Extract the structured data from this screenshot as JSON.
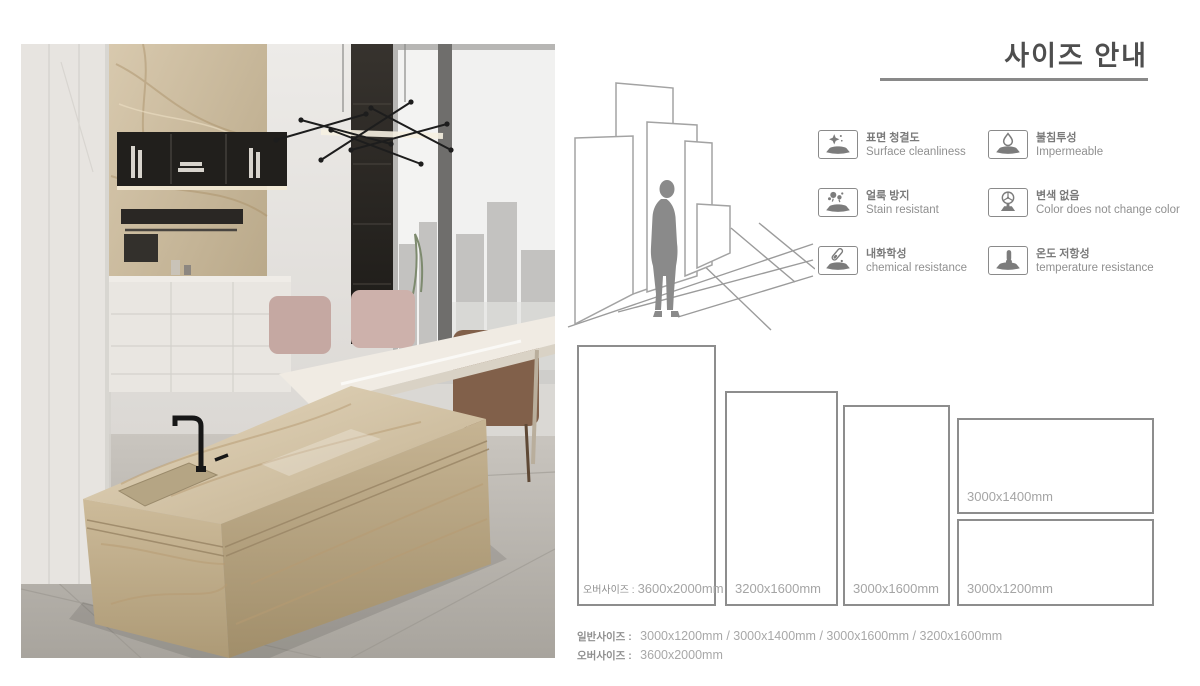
{
  "page": {
    "title": "사이즈 안내"
  },
  "features": [
    {
      "ko": "표면 청결도",
      "en": "Surface cleanliness",
      "icon": "sparkle-clean-icon"
    },
    {
      "ko": "불침투성",
      "en": "Impermeable",
      "icon": "water-drop-icon"
    },
    {
      "ko": "얼룩 방지",
      "en": "Stain resistant",
      "icon": "stain-splatter-icon"
    },
    {
      "ko": "변색 없음",
      "en": "Color does not change color",
      "icon": "color-wheel-icon"
    },
    {
      "ko": "내화학성",
      "en": "chemical resistance",
      "icon": "test-tube-icon"
    },
    {
      "ko": "온도 저항성",
      "en": "temperature resistance",
      "icon": "thermometer-icon"
    }
  ],
  "size_boxes": [
    {
      "prefix": "오버사이즈 :",
      "size": "3600x2000mm"
    },
    {
      "prefix": "",
      "size": "3200x1600mm"
    },
    {
      "prefix": "",
      "size": "3000x1600mm"
    },
    {
      "prefix": "",
      "size": "3000x1400mm"
    },
    {
      "prefix": "",
      "size": "3000x1200mm"
    }
  ],
  "footer": {
    "normal_label": "일반사이즈 :",
    "normal_sizes": "3000x1200mm / 3000x1400mm / 3000x1600mm / 3200x1600mm",
    "over_label": "오버사이즈 :",
    "over_sizes": "3600x2000mm"
  },
  "colors": {
    "title_gray": "#4e4e4e",
    "rule_gray": "#898989",
    "box_border_gray": "#8d8d8d",
    "label_gray": "#a5a5a5",
    "marble_beige": "#c9b797"
  }
}
